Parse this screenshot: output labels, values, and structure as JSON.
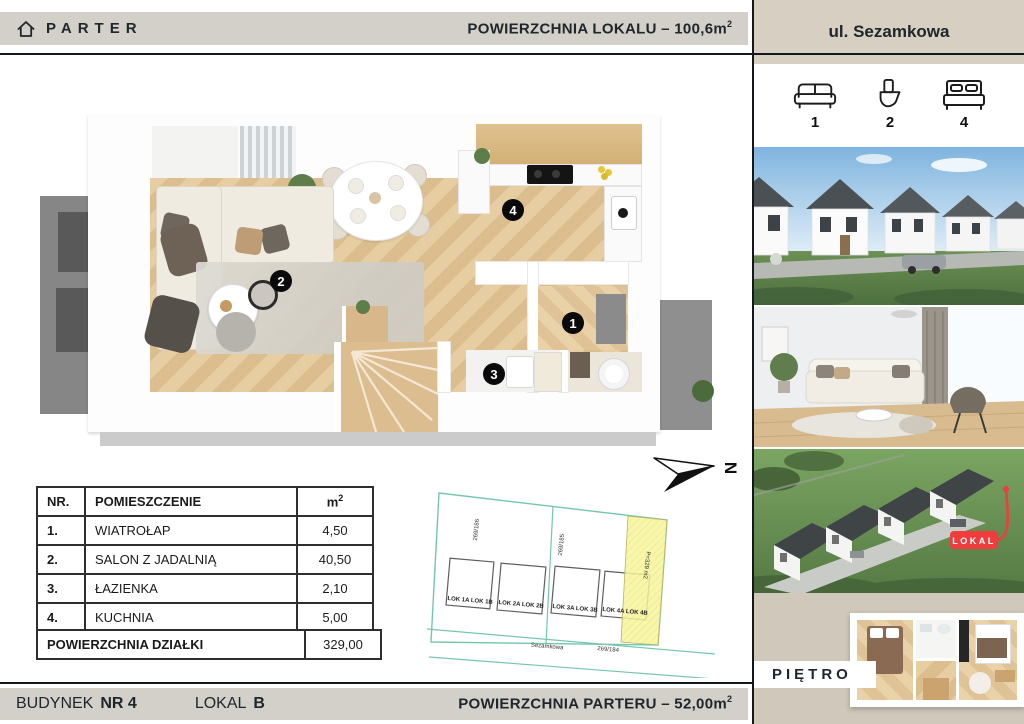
{
  "header": {
    "floor_label": "PARTER",
    "area_text": "POWIERZCHNIA LOKALU – 100,6m",
    "area_sup": "2",
    "street": "ul. Sezamkowa"
  },
  "amenities": {
    "sofa_count": "1",
    "toilet_count": "2",
    "bed_count": "4"
  },
  "floorplan": {
    "badge_1": "1",
    "badge_2": "2",
    "badge_3": "3",
    "badge_4": "4",
    "compass_letter": "N"
  },
  "rooms_table": {
    "head_nr": "NR.",
    "head_name": "POMIESZCZENIE",
    "head_area": "m",
    "head_area_sup": "2",
    "rows": [
      {
        "nr": "1.",
        "name": "WIATROŁAP",
        "area": "4,50"
      },
      {
        "nr": "2.",
        "name": "SALON Z JADALNIĄ",
        "area": "40,50"
      },
      {
        "nr": "3.",
        "name": "ŁAZIENKA",
        "area": "2,10"
      },
      {
        "nr": "4.",
        "name": "KUCHNIA",
        "area": "5,00"
      }
    ],
    "summary_label": "POWIERZCHNIA DZIAŁKI",
    "summary_value": "329,00"
  },
  "site_plan": {
    "parcel_left": "269/186",
    "parcel_right": "269/185",
    "highlight_label": "P=329 m2",
    "street_name": "Sezamkowa",
    "street_parcel": "269/184",
    "lots": [
      "LOK 1A  LOK 1B",
      "LOK 2A  LOK 2B",
      "LOK 3A  LOK 3B",
      "LOK 4A  LOK 4B"
    ]
  },
  "footer": {
    "building_label": "BUDYNEK",
    "building_no": "NR 4",
    "unit_label": "LOKAL",
    "unit_no": "B",
    "area_text": "POWIERZCHNIA PARTERU – 52,00m",
    "area_sup": "2"
  },
  "right_panel": {
    "photo_badge": "LOKAL",
    "floor_below_label": "PIĘTRO"
  },
  "colors": {
    "accent_red": "#f03c3c",
    "plot_teal": "#74c6ae",
    "highlight_yellow": "#f7f49c",
    "bar_gray": "#d3d0c9",
    "panel_beige": "#d6cfc2",
    "ink": "#20262c"
  }
}
